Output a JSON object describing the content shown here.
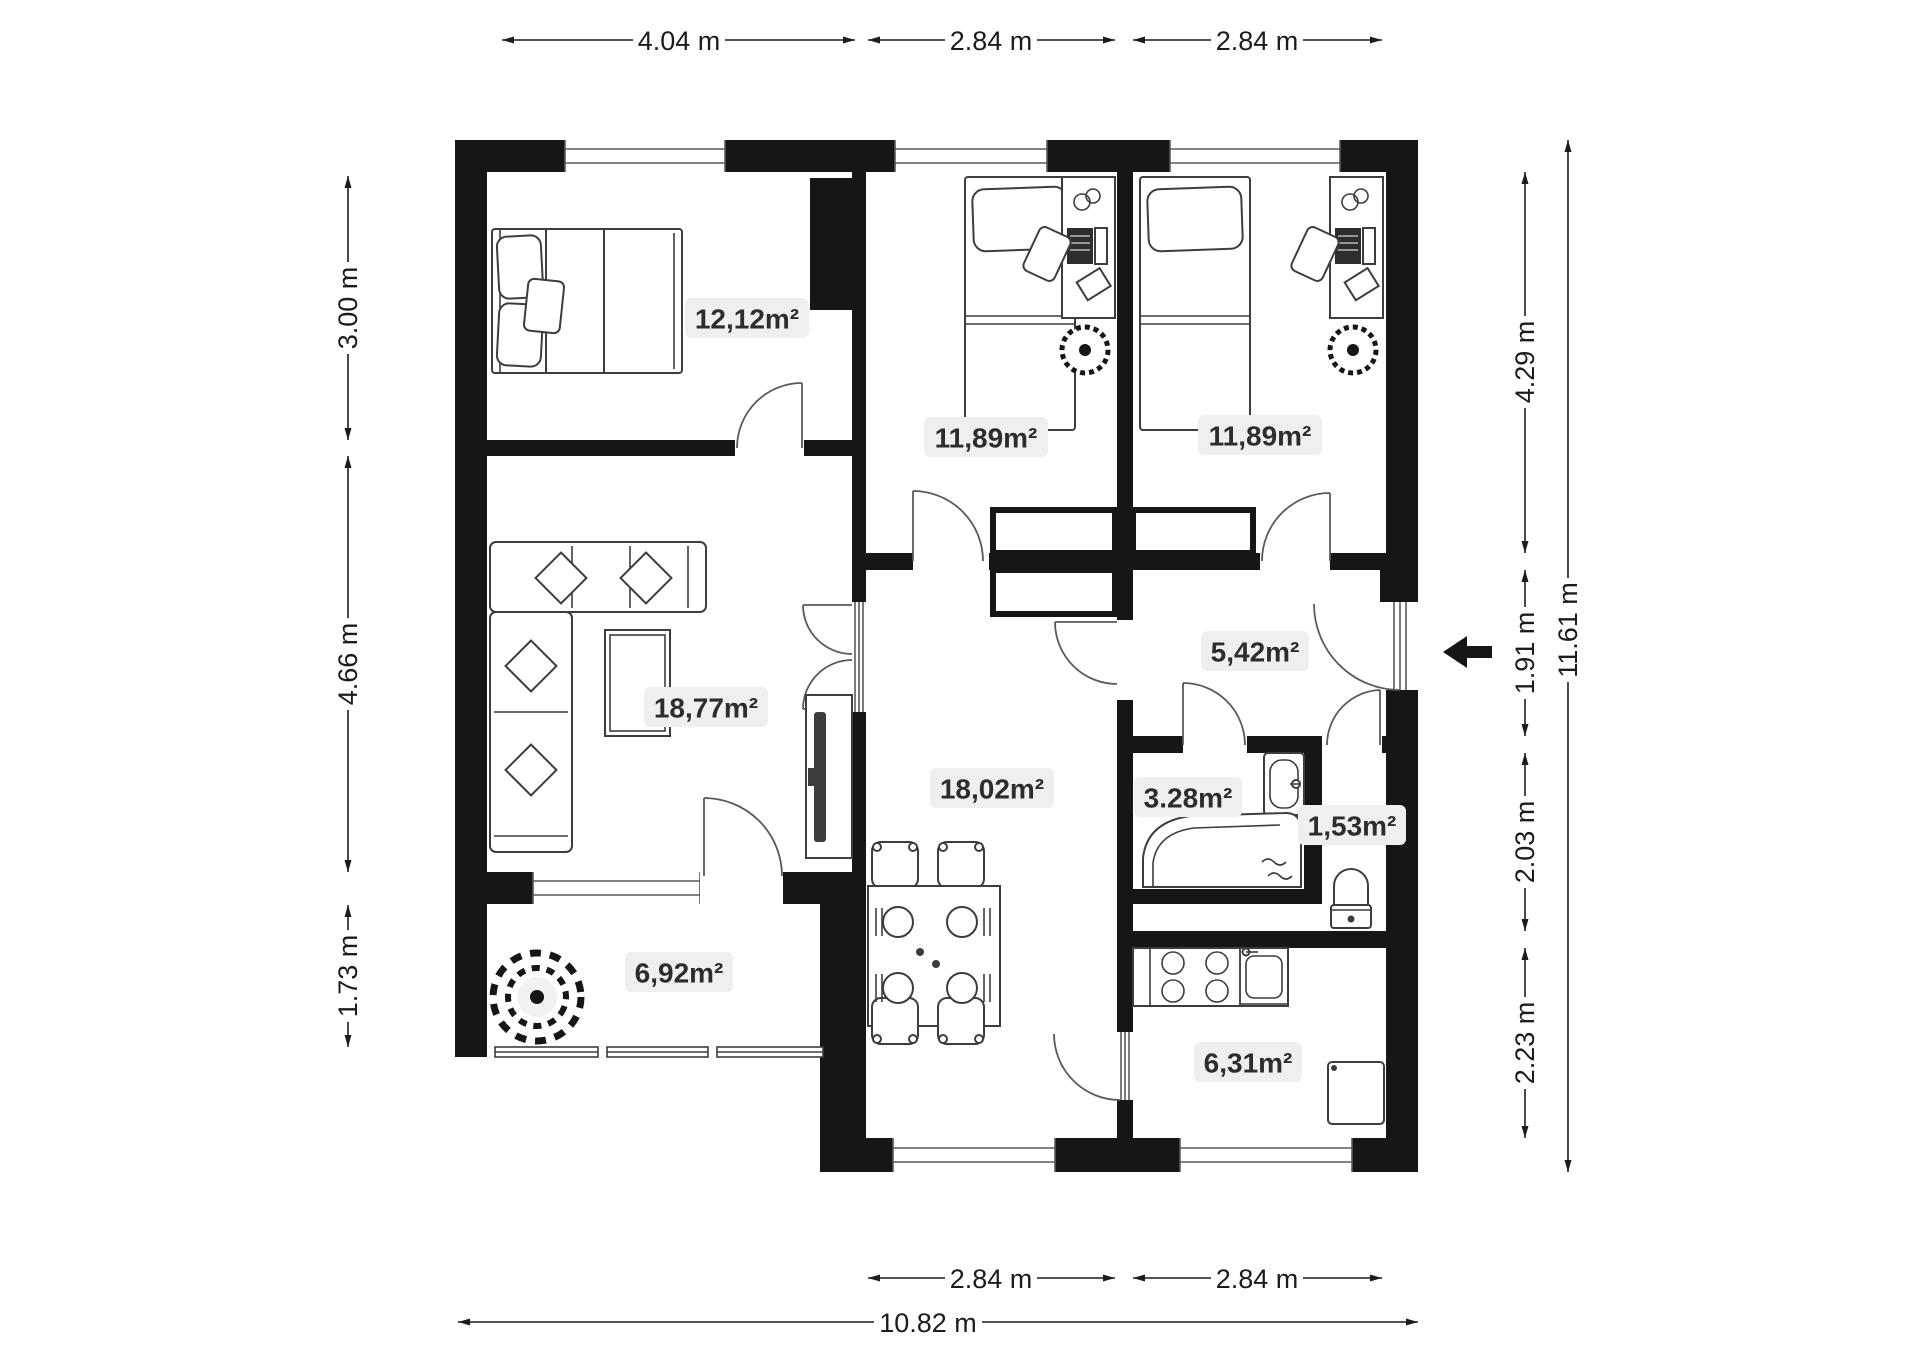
{
  "rooms": [
    {
      "id": "bedroom",
      "area_label": "12,12m²"
    },
    {
      "id": "kids-room-1",
      "area_label": "11,89m²"
    },
    {
      "id": "kids-room-2",
      "area_label": "11,89m²"
    },
    {
      "id": "living-room",
      "area_label": "18,77m²"
    },
    {
      "id": "dining-room",
      "area_label": "18,02m²"
    },
    {
      "id": "hallway",
      "area_label": "5,42m²"
    },
    {
      "id": "bathroom",
      "area_label": "3.28m²"
    },
    {
      "id": "wc",
      "area_label": "1,53m²"
    },
    {
      "id": "terrace",
      "area_label": "6,92m²"
    },
    {
      "id": "kitchen",
      "area_label": "6,31m²"
    }
  ],
  "dimensions": {
    "top": [
      "4.04 m",
      "2.84 m",
      "2.84 m"
    ],
    "left": [
      "3.00 m",
      "4.66 m",
      "1.73 m"
    ],
    "right": [
      "4.29 m",
      "1.91 m",
      "2.03 m",
      "2.23 m"
    ],
    "right_total": "11.61 m",
    "bottom": [
      "2.84 m",
      "2.84 m"
    ],
    "bottom_total": "10.82 m"
  },
  "icons": {
    "entrance_arrow": "left-arrow"
  },
  "colors": {
    "wall": "#161616",
    "label_background": "#efefef",
    "label_text": "#2d2d2d"
  }
}
